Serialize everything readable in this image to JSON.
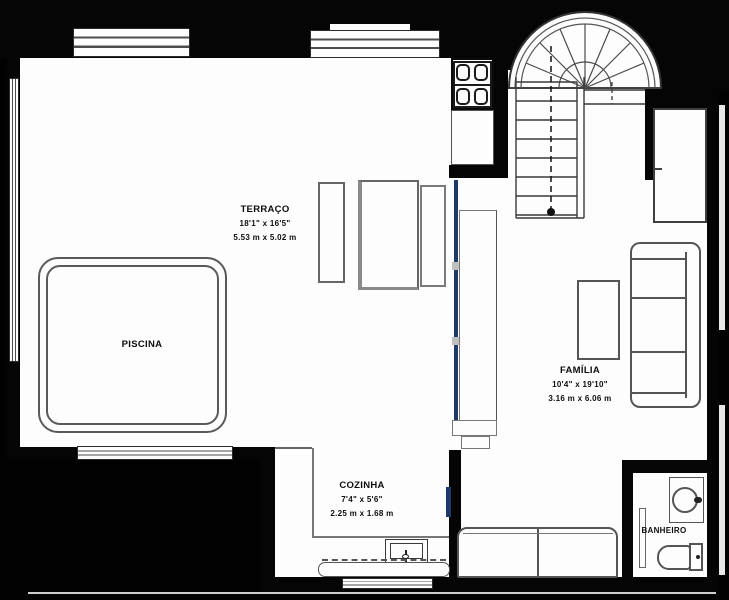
{
  "plan": {
    "type": "residential floor plan",
    "rooms": {
      "terraco": {
        "name": "TERRAÇO",
        "imperial": "18'1\" x 16'5\"",
        "metric": "5.53 m x 5.02 m"
      },
      "piscina": {
        "name": "PISCINA"
      },
      "familia": {
        "name": "FAMÍLIA",
        "imperial": "10'4\" x 19'10\"",
        "metric": "3.16 m x 6.06 m"
      },
      "cozinha": {
        "name": "COZINHA",
        "imperial": "7'4\" x 5'6\"",
        "metric": "2.25 m x 1.68 m"
      },
      "banheiro": {
        "name": "BANHEIRO"
      }
    },
    "colors": {
      "wall": "#050505",
      "floor": "#fdfdfd",
      "line": "#555555",
      "glass_door": "#1d3a69"
    },
    "fixtures": [
      "swimming-pool",
      "winder-staircase",
      "stove-4-burner",
      "kitchen-counter",
      "kitchen-sink",
      "dining-table",
      "bench",
      "bench",
      "sofa-3-seat",
      "sofa-2-seat",
      "coffee-table",
      "wardrobe",
      "bathroom-sink-basin",
      "toilet",
      "sliding-glass-door",
      "window"
    ]
  }
}
